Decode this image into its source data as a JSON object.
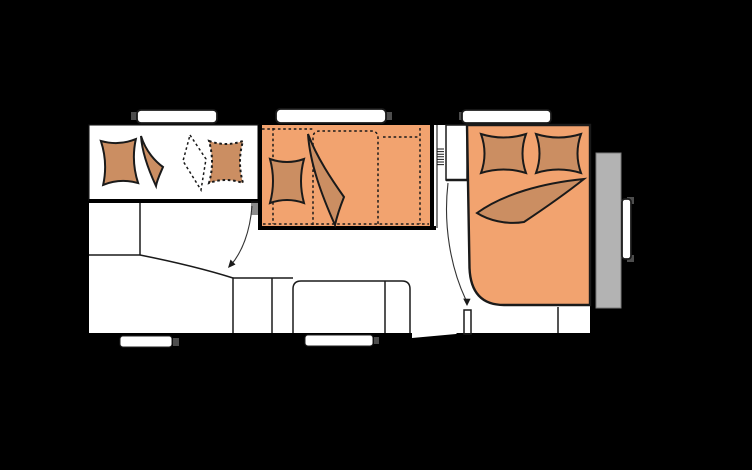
{
  "colors": {
    "background": "#000000",
    "wall": "#000000",
    "floor": "#ffffff",
    "outline": "#1a1a1a",
    "upholstery": "#f2a36f",
    "cushion": "#cb8e62",
    "window": "#ffffff",
    "rear_panel": "#b3b3b3",
    "hardware_gray": "#4d4d4d",
    "arrow": "#333333"
  }
}
